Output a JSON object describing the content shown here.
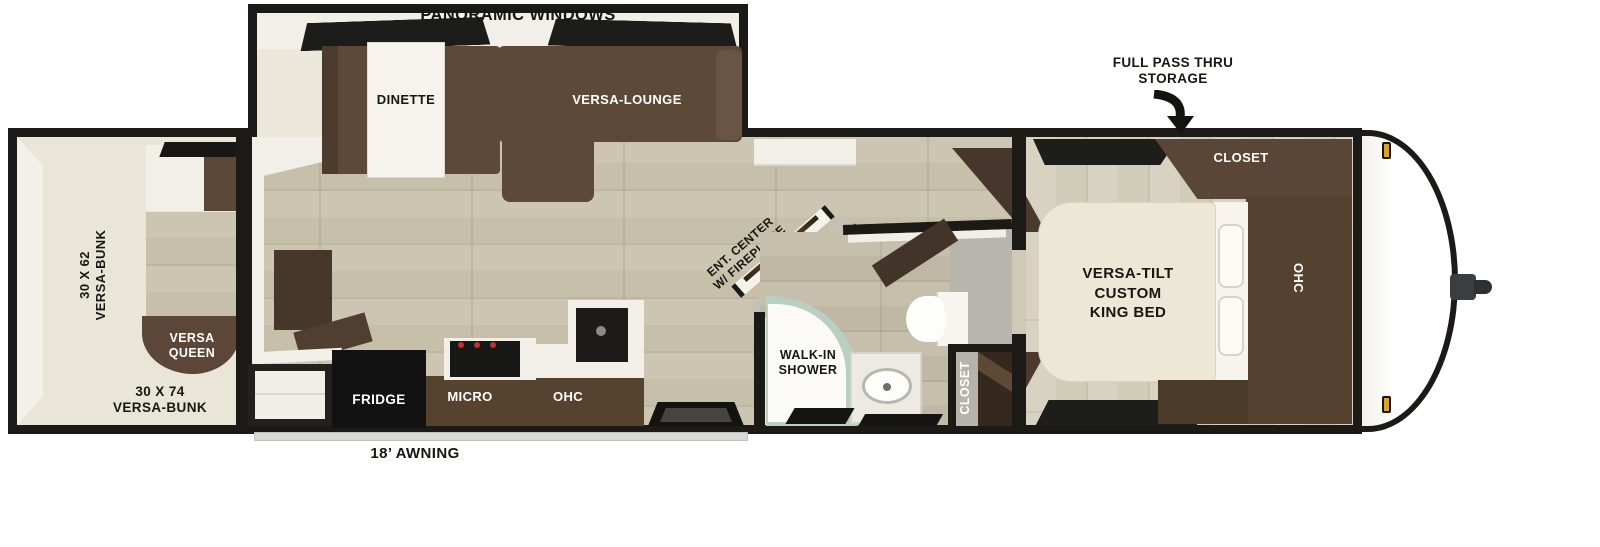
{
  "floorplan": {
    "slideout": {
      "title": "PANORAMIC WINDOWS",
      "dinette_label": "DINETTE",
      "lounge_label": "VERSA-LOUNGE"
    },
    "bunk_room": {
      "bunk_left_label": "30 X 62\nVERSA-BUNK",
      "queen_label": "VERSA\nQUEEN",
      "bunk_bottom_label": "30 X 74\nVERSA-BUNK"
    },
    "living": {
      "ent_center_label": "ENT. CENTER\nW/ FIREPLACE",
      "fridge_label": "FRIDGE",
      "micro_label": "MICRO",
      "ohc_label": "OHC"
    },
    "bath": {
      "shower_label": "WALK-IN\nSHOWER",
      "closet_label": "CLOSET"
    },
    "bedroom": {
      "bed_label": "VERSA-TILT\nCUSTOM\nKING BED",
      "closet_label": "CLOSET",
      "ohc_label": "OHC"
    },
    "exterior": {
      "storage_label": "FULL PASS THRU\nSTORAGE",
      "awning_label": "18’ AWNING"
    },
    "colors": {
      "outline": "#1b1a17",
      "wood_floor": "#cbc5b1",
      "slide_floor": "#ebe8db",
      "furniture_brown": "#5a4636",
      "dark_brown": "#43342a",
      "mattress_cream": "#ece8d5",
      "shower_mint": "#b9cfc2",
      "bath_gray": "#b6b4ac",
      "marker_amber": "#dba22e"
    }
  }
}
